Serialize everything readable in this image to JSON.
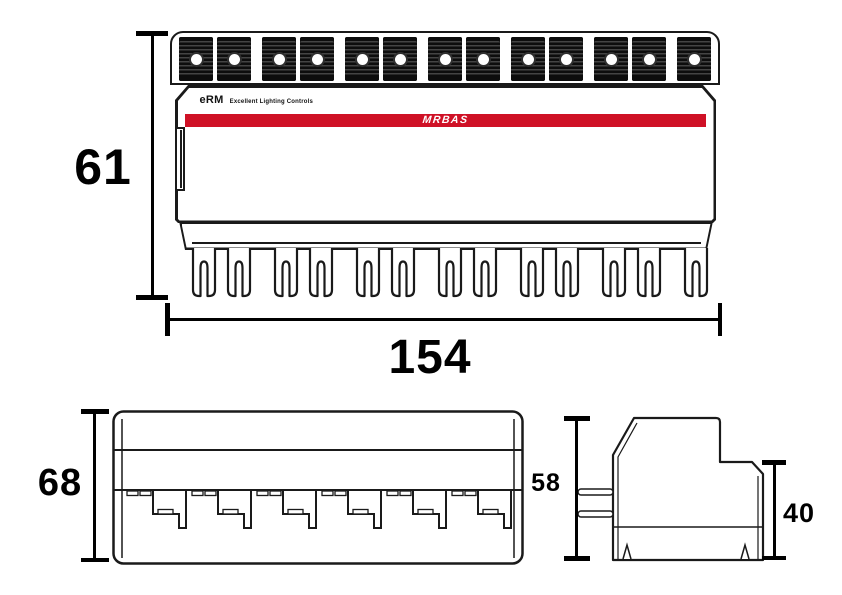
{
  "drawing": {
    "title": "lighting-control-module-dimension-drawing",
    "product": {
      "brand_small": "eRM",
      "tagline": "Excellent Lighting Controls",
      "logo": "MRBAS"
    },
    "dimensions": {
      "front_height": "61",
      "front_width": "154",
      "bottom_height": "68",
      "side_height": "58",
      "side_step_height": "40"
    },
    "counts": {
      "terminal_blocks": 13,
      "fork_terminals": 13,
      "step_notches": 6,
      "side_pins": 2,
      "bottom_notches": 2
    },
    "colors": {
      "accent_red": "#cf1126",
      "line": "#1a1a1a",
      "dimension": "#000000"
    }
  }
}
